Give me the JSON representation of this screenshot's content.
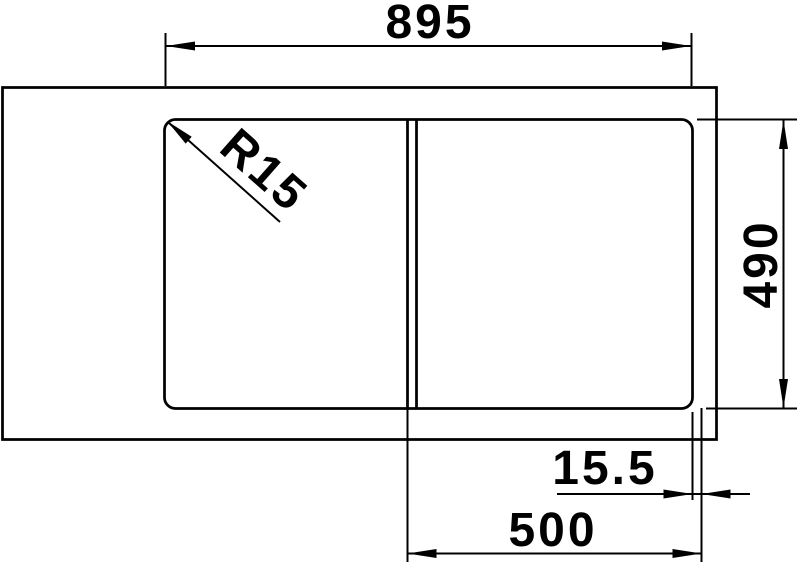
{
  "colors": {
    "line": "#000000",
    "background": "#ffffff"
  },
  "dimensions": {
    "overall_width": {
      "value": "895"
    },
    "corner_radius": {
      "value": "R15"
    },
    "depth": {
      "value": "490"
    },
    "divider_thickness": {
      "value": "15.5"
    },
    "bowl_width": {
      "value": "500"
    }
  }
}
